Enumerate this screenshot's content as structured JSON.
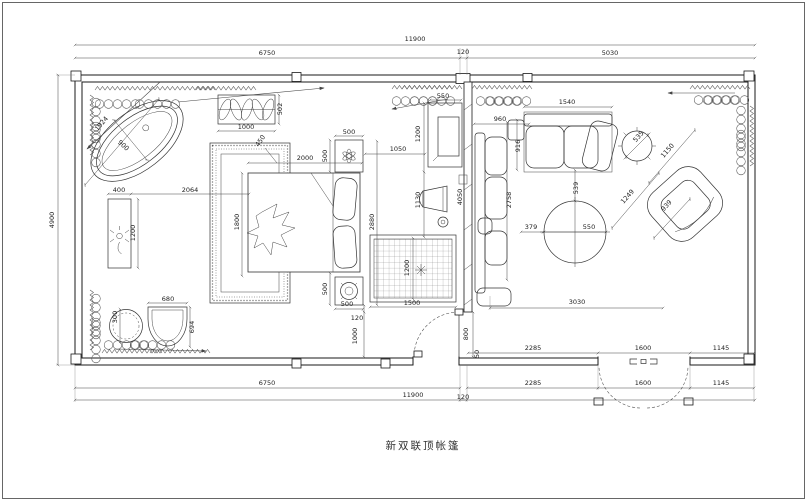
{
  "title": "新双联顶帐篷",
  "colors": {
    "background": "#ffffff",
    "line": "#2e2e2e",
    "dim_text": "#1d1d1d"
  },
  "plan": {
    "overall_width": "11900",
    "overall_depth": "4900",
    "dim_labels": [
      {
        "t": "11900",
        "x": 415,
        "y": 41
      },
      {
        "t": "6750",
        "x": 267,
        "y": 55
      },
      {
        "t": "120",
        "x": 463,
        "y": 54
      },
      {
        "t": "5030",
        "x": 610,
        "y": 55
      },
      {
        "t": "4900",
        "x": 54,
        "y": 220,
        "r": -90
      },
      {
        "t": "2285",
        "x": 533,
        "y": 350
      },
      {
        "t": "1600",
        "x": 643,
        "y": 350
      },
      {
        "t": "1145",
        "x": 721,
        "y": 350
      },
      {
        "t": "6750",
        "x": 267,
        "y": 385
      },
      {
        "t": "2285",
        "x": 533,
        "y": 385
      },
      {
        "t": "1600",
        "x": 643,
        "y": 385
      },
      {
        "t": "1145",
        "x": 721,
        "y": 385
      },
      {
        "t": "11900",
        "x": 413,
        "y": 397
      },
      {
        "t": "120",
        "x": 463,
        "y": 399
      },
      {
        "t": "1924",
        "x": 103,
        "y": 125,
        "r": -49
      },
      {
        "t": "900",
        "x": 122,
        "y": 147,
        "r": 42
      },
      {
        "t": "1000",
        "x": 246,
        "y": 129
      },
      {
        "t": "502",
        "x": 282,
        "y": 109,
        "r": -90
      },
      {
        "t": "450",
        "x": 262,
        "y": 142,
        "r": -55
      },
      {
        "t": "400",
        "x": 119,
        "y": 192
      },
      {
        "t": "2064",
        "x": 190,
        "y": 192
      },
      {
        "t": "1200",
        "x": 135,
        "y": 233,
        "r": -90
      },
      {
        "t": "300",
        "x": 117,
        "y": 317,
        "r": -90
      },
      {
        "t": "680",
        "x": 168,
        "y": 301
      },
      {
        "t": "694",
        "x": 194,
        "y": 327,
        "r": -90
      },
      {
        "t": "2000",
        "x": 305,
        "y": 160
      },
      {
        "t": "500",
        "x": 349,
        "y": 134
      },
      {
        "t": "500",
        "x": 327,
        "y": 156,
        "r": -90
      },
      {
        "t": "1800",
        "x": 239,
        "y": 222,
        "r": -90
      },
      {
        "t": "2880",
        "x": 374,
        "y": 222,
        "r": -90
      },
      {
        "t": "500",
        "x": 327,
        "y": 289,
        "r": -90
      },
      {
        "t": "500",
        "x": 347,
        "y": 306
      },
      {
        "t": "120",
        "x": 357,
        "y": 320
      },
      {
        "t": "1000",
        "x": 357,
        "y": 336,
        "r": -90
      },
      {
        "t": "1500",
        "x": 412,
        "y": 305
      },
      {
        "t": "1200",
        "x": 409,
        "y": 268,
        "r": -90
      },
      {
        "t": "550",
        "x": 443,
        "y": 98
      },
      {
        "t": "1200",
        "x": 420,
        "y": 134,
        "r": -90
      },
      {
        "t": "1050",
        "x": 398,
        "y": 151
      },
      {
        "t": "1130",
        "x": 420,
        "y": 200,
        "r": -90
      },
      {
        "t": "4050",
        "x": 462,
        "y": 197,
        "r": -90
      },
      {
        "t": "800",
        "x": 468,
        "y": 334,
        "r": -90
      },
      {
        "t": "50",
        "x": 479,
        "y": 354,
        "r": -90
      },
      {
        "t": "960",
        "x": 500,
        "y": 121
      },
      {
        "t": "1540",
        "x": 567,
        "y": 104
      },
      {
        "t": "916",
        "x": 520,
        "y": 146,
        "r": -90
      },
      {
        "t": "2758",
        "x": 511,
        "y": 200,
        "r": -90
      },
      {
        "t": "539",
        "x": 578,
        "y": 188,
        "r": -90
      },
      {
        "t": "379",
        "x": 531,
        "y": 229
      },
      {
        "t": "550",
        "x": 589,
        "y": 229
      },
      {
        "t": "3030",
        "x": 577,
        "y": 304
      },
      {
        "t": "535",
        "x": 640,
        "y": 138,
        "r": -49
      },
      {
        "t": "1150",
        "x": 669,
        "y": 152,
        "r": -49
      },
      {
        "t": "1249",
        "x": 629,
        "y": 198,
        "r": -48
      },
      {
        "t": "939",
        "x": 668,
        "y": 207,
        "r": -48
      }
    ]
  }
}
